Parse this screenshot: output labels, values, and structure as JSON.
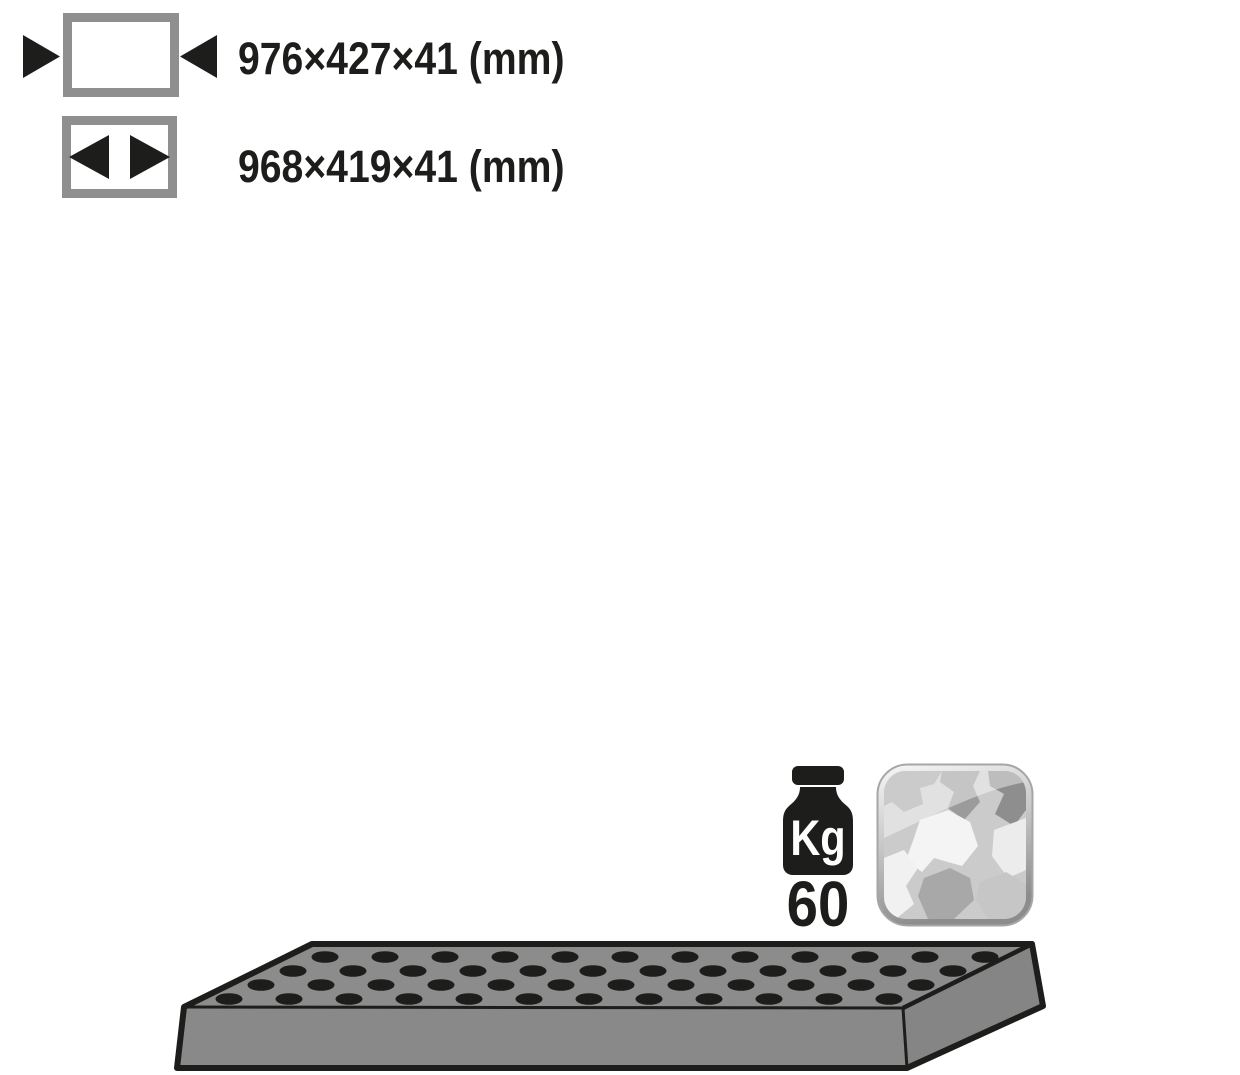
{
  "dimensions": {
    "outer": {
      "icon": "outer-dimensions-icon",
      "value": "976×427×41 (mm)"
    },
    "inner": {
      "icon": "inner-dimensions-icon",
      "value": "968×419×41 (mm)"
    }
  },
  "max_load": {
    "icon": "weight-icon",
    "unit_label": "Kg",
    "value": "60"
  },
  "material": {
    "icon": "galvanized-steel-texture-icon"
  },
  "illustration": {
    "name": "perforated-metal-shelf"
  },
  "colors": {
    "ink": "#1d1d1b",
    "icon_frame_gray": "#8f8f8f",
    "shelf_gray": "#8a8a8a",
    "background": "#ffffff"
  }
}
